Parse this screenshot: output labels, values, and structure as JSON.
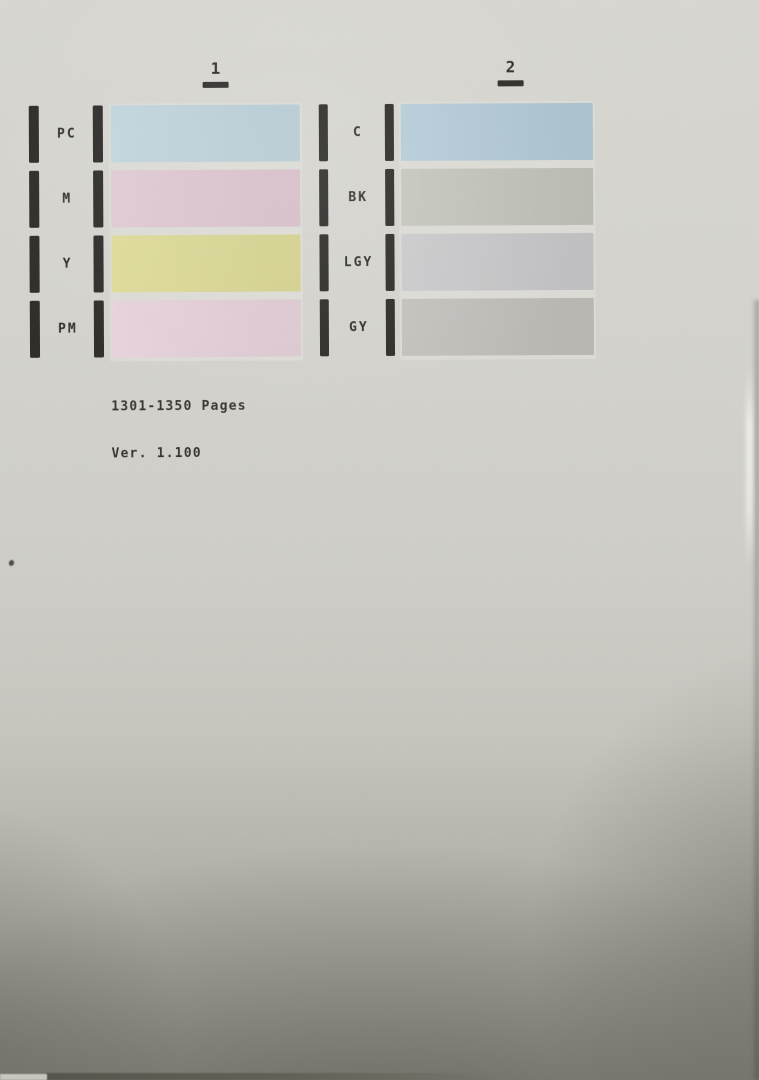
{
  "photo": {
    "paper_color_top": "#d8d7d2",
    "paper_color_bottom": "#8d8c82",
    "ink_color": "#2e2d2a"
  },
  "test_chart": {
    "columns": [
      {
        "number": "1",
        "rows": [
          {
            "label": "PC",
            "color": "#bed3dc"
          },
          {
            "label": "M",
            "color": "#dfc6d1"
          },
          {
            "label": "Y",
            "color": "#dcd993"
          },
          {
            "label": "PM",
            "color": "#e6d0da"
          }
        ]
      },
      {
        "number": "2",
        "rows": [
          {
            "label": "C",
            "color": "#b2cad7"
          },
          {
            "label": "BK",
            "color": "#c2c4ba"
          },
          {
            "label": "LGY",
            "color": "#c8c7c9"
          },
          {
            "label": "GY",
            "color": "#c1beba"
          }
        ]
      }
    ],
    "footer": {
      "line1": "1301-1350 Pages",
      "line2": "Ver. 1.100"
    }
  }
}
